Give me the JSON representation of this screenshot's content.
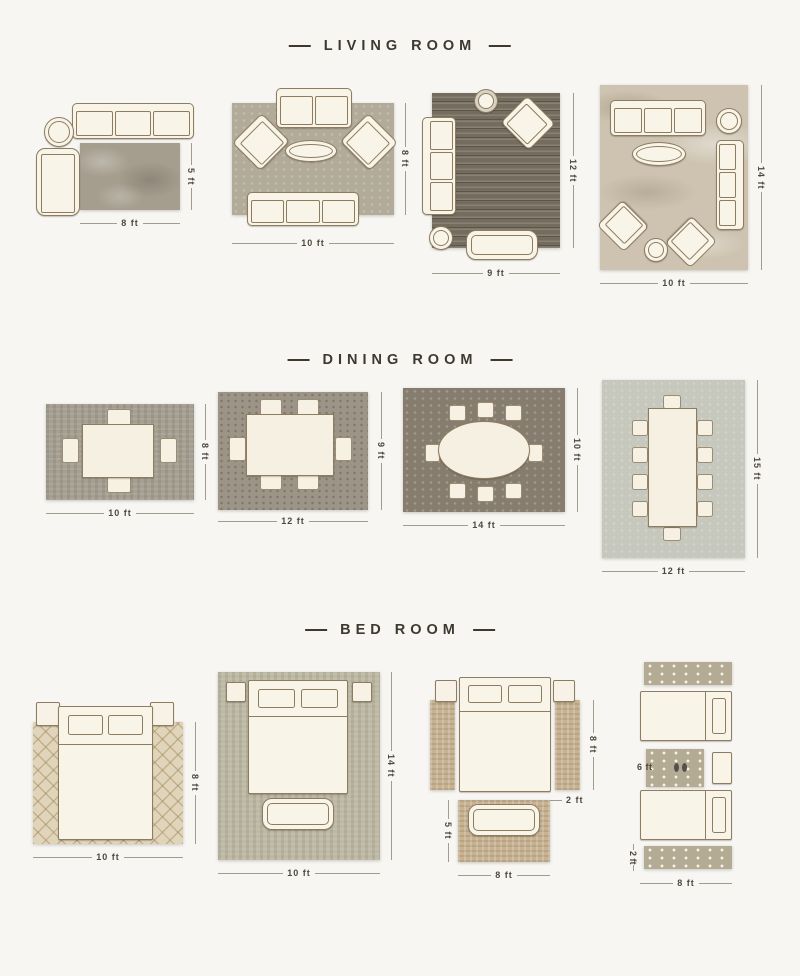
{
  "page": {
    "background": "#f7f6f3"
  },
  "palette": {
    "furniture_fill": "#f9f4e8",
    "furniture_outline": "#8d7c60",
    "title_color": "#3e382f",
    "dimension_text": "#4e483f",
    "dimension_line": "#a29c90"
  },
  "sections": [
    {
      "id": "living-room",
      "title": "LIVING ROOM",
      "layouts": [
        {
          "width": "8 ft",
          "height": "5 ft",
          "rug_color": "#a59d8e"
        },
        {
          "width": "10 ft",
          "height": "8 ft",
          "rug_color": "#b2ab99"
        },
        {
          "width": "9 ft",
          "height": "12 ft",
          "rug_color": "#746c5e"
        },
        {
          "width": "10 ft",
          "height": "14 ft",
          "rug_color": "#cdc3b0"
        }
      ]
    },
    {
      "id": "dining-room",
      "title": "DINING ROOM",
      "layouts": [
        {
          "width": "10 ft",
          "height": "8 ft",
          "rug_color": "#a69f91"
        },
        {
          "width": "12 ft",
          "height": "9 ft",
          "rug_color": "#9c9486"
        },
        {
          "width": "14 ft",
          "height": "10 ft",
          "rug_color": "#867d6f"
        },
        {
          "width": "12 ft",
          "height": "15 ft",
          "rug_color": "#c6c7bd"
        }
      ]
    },
    {
      "id": "bed-room",
      "title": "BED ROOM",
      "layouts": [
        {
          "width": "10 ft",
          "height": "8 ft",
          "rug_color": "#e0d4ba"
        },
        {
          "width": "10 ft",
          "height": "14 ft",
          "rug_color": "#bdb9a4"
        },
        {
          "bed_height": "8 ft",
          "runner_width": "2 ft",
          "foot_rug_width": "8 ft",
          "foot_rug_height": "5 ft",
          "rug_color": "#c7b292"
        },
        {
          "small_rug_length": "6 ft",
          "runner_height": "2 ft",
          "width": "8 ft",
          "rug_color": "#b3ab94"
        }
      ]
    }
  ]
}
